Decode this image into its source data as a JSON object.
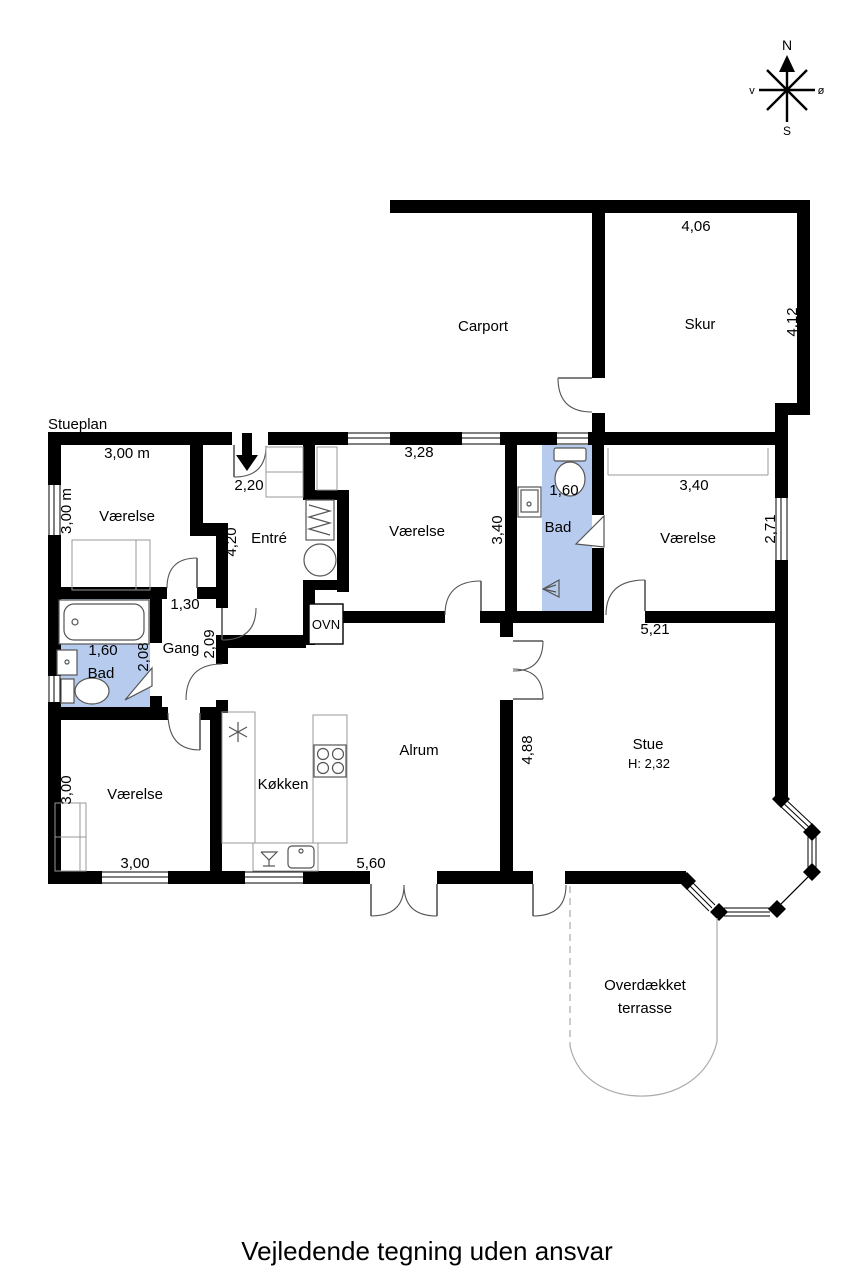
{
  "plan_title": "Stueplan",
  "footer_note": "Vejledende tegning uden ansvar",
  "compass": {
    "north": "N",
    "south": "S",
    "west": "v",
    "east": "ø"
  },
  "outbuildings": {
    "carport": {
      "label": "Carport"
    },
    "skur": {
      "label": "Skur",
      "width": "4,06",
      "depth": "4,12"
    }
  },
  "rooms": {
    "vaerelse_nw": {
      "label": "Værelse",
      "width": "3,00 m",
      "depth": "3,00 m"
    },
    "entre": {
      "label": "Entré",
      "entry_width": "2,20",
      "depth": "4,20"
    },
    "vaerelse_n": {
      "label": "Værelse",
      "width": "3,28",
      "depth": "3,40"
    },
    "bad_n": {
      "label": "Bad",
      "width": "1,60"
    },
    "vaerelse_ne": {
      "label": "Værelse",
      "width": "3,40",
      "depth": "2,71"
    },
    "gang": {
      "label": "Gang",
      "width": "1,30",
      "depth": "2,09"
    },
    "bad_w": {
      "label": "Bad",
      "width": "1,60",
      "depth": "2,08"
    },
    "vaerelse_sw": {
      "label": "Værelse",
      "width": "3,00",
      "depth": "3,00"
    },
    "koekken": {
      "label": "Køkken"
    },
    "alrum": {
      "label": "Alrum",
      "width": "5,60",
      "depth": "4,88"
    },
    "stue": {
      "label": "Stue",
      "width": "5,21",
      "ceiling_height": "H: 2,32"
    },
    "ovn": {
      "label": "OVN"
    },
    "terrasse": {
      "label_line1": "Overdækket",
      "label_line2": "terrasse"
    }
  },
  "colors": {
    "bathroom_fill": "#b6cbee",
    "wall": "#000000"
  }
}
